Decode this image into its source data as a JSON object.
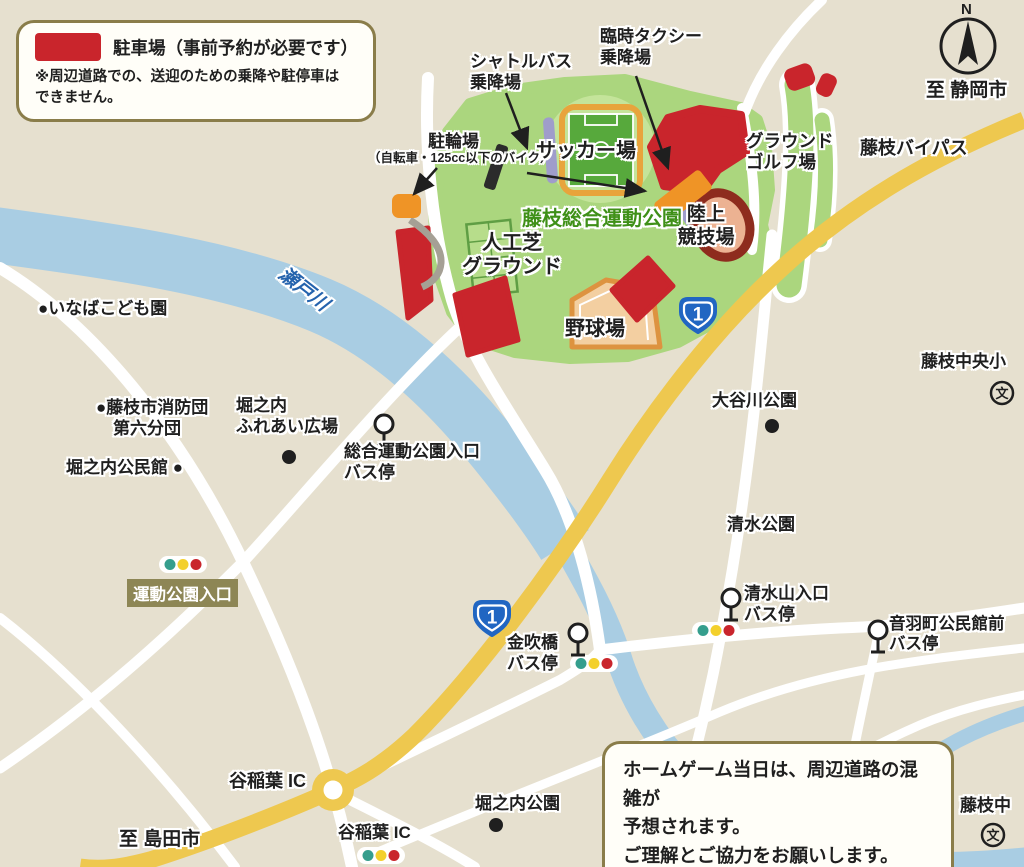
{
  "colors": {
    "parking_red": "#c9252c",
    "bypass_yellow": "#eec84f",
    "park_green": "#abd67e",
    "river_blue": "#a9cde3",
    "route_shield_blue": "#2166c2"
  },
  "legend": {
    "title": "駐車場（事前予約が必要です）",
    "note": "※周辺道路での、送迎のための乗降や駐停車は\nできません。"
  },
  "notice": "ホームゲーム当日は、周辺道路の混雑が\n予想されます。\nご理解とご協力をお願いします。",
  "compass": {
    "letter": "N"
  },
  "routes": {
    "national_route_number": "1",
    "bypass_label": "藤枝バイパス"
  },
  "destinations": {
    "shizuoka": "至 静岡市",
    "shimada": "至 島田市"
  },
  "park": {
    "name": "藤枝総合運動公園",
    "soccer": "サッカー場",
    "athletics": "陸上\n競技場",
    "turf": "人工芝\nグラウンド",
    "baseball": "野球場",
    "ground_golf": "グラウンド\nゴルフ場"
  },
  "boarding": {
    "shuttle": "シャトルバス\n乗降場",
    "taxi": "臨時タクシー\n乗降場",
    "bicycle": "駐輪場",
    "bicycle_note": "（自転車・125cc以下のバイク）"
  },
  "bus_stops": {
    "sogo": "総合運動公園入口\nバス停",
    "shimizuyama": "清水山入口\nバス停",
    "otowa": "音羽町公民館前\nバス停",
    "kanabuki": "金吹橋\nバス停"
  },
  "intersections": {
    "undo_koen": "運動公園入口"
  },
  "interchanges": {
    "top": "谷稲葉 IC",
    "bottom": "谷稲葉 IC"
  },
  "places": {
    "river": "瀬戸川",
    "inaba": "●いなばこども園",
    "fire_brigade": "●藤枝市消防団\n　第六分団",
    "horinouchi_hiroba": "堀之内\nふれあい広場",
    "horinouchi_kominkan": "堀之内公民館 ●",
    "otanigawa_park": "大谷川公園",
    "fujieda_chuo_elem": "藤枝中央小",
    "shimizu_park": "清水公園",
    "horinouchi_park": "堀之内公園",
    "fujieda_jhs": "藤枝中"
  },
  "icons": {
    "school_mark": "文"
  }
}
